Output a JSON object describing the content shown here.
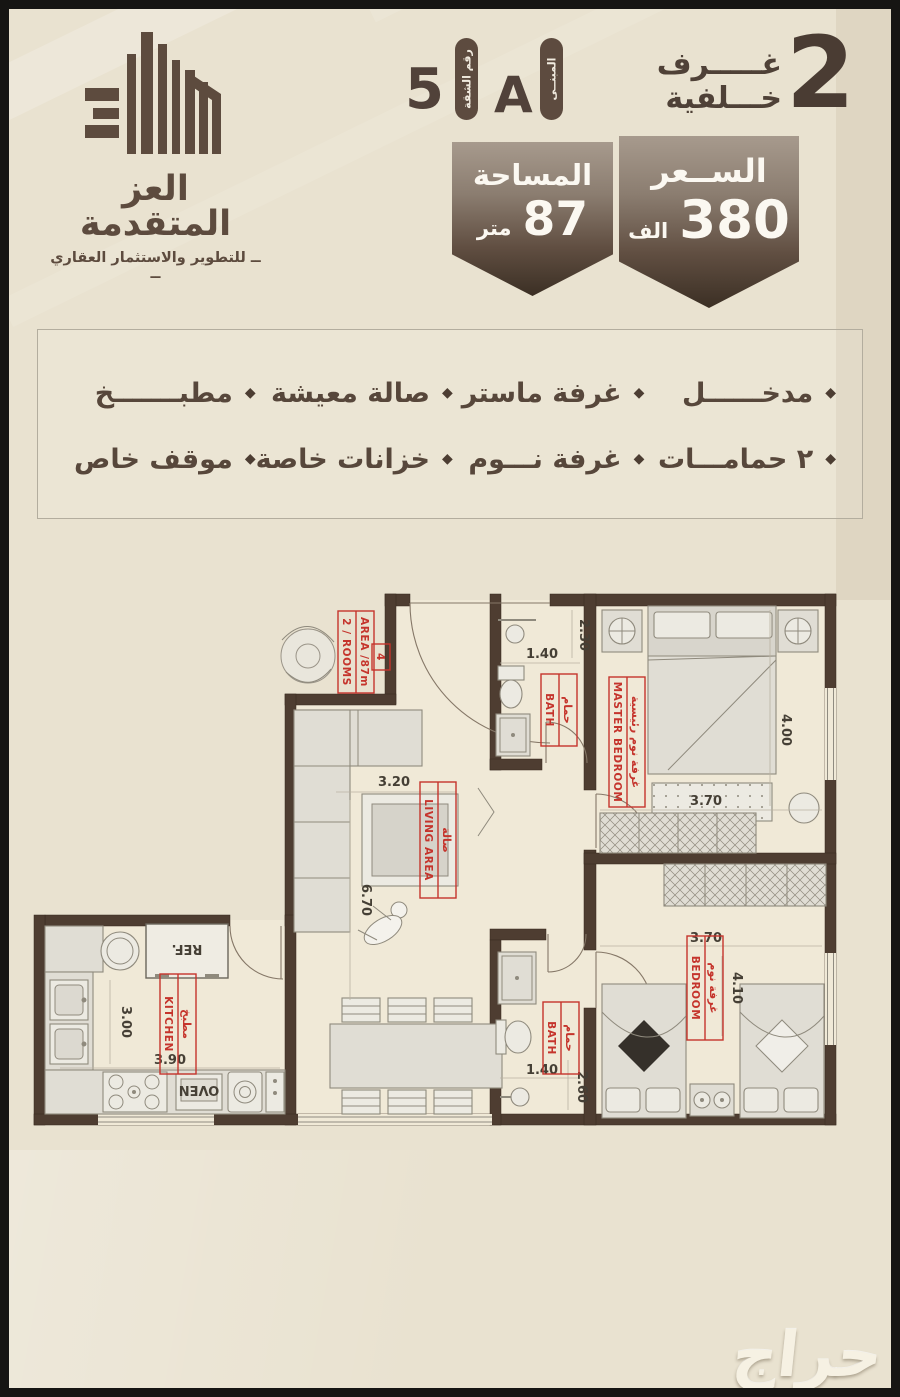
{
  "colors": {
    "brand_brown": "#5d4b3f",
    "header_text": "#4f4137",
    "badge_dark": "#3b2f24",
    "badge_light": "#a79a8d",
    "label_red": "#c5342c",
    "wall": "#4e3d31",
    "background": "#e9e2d0",
    "frame": "#161513"
  },
  "header": {
    "logo": {
      "title": "العز المتقدمة",
      "subtitle": "ــ للتطوير والاستثمار العقاري ــ"
    },
    "unit": {
      "number": "5",
      "number_label": "رقم الشقة",
      "building": "A",
      "building_label": "المبنــى"
    },
    "rooms": {
      "count": "2",
      "word": "غـــــرف",
      "type": "خـــلفية"
    }
  },
  "badges": {
    "area": {
      "title": "المساحة",
      "value": "87",
      "unit": "متر"
    },
    "price": {
      "title": "الســعر",
      "value": "380",
      "unit": "الف"
    }
  },
  "features": {
    "rows": [
      [
        "مدخــــــل",
        "غرفة ماستر",
        "صالة معيشة",
        "مطبـــــــخ"
      ],
      [
        "٢ حمامـــات",
        "غرفة نـــوم",
        "خزانات خاصة",
        "موقف خاص"
      ]
    ]
  },
  "floorplan": {
    "unit_tag": {
      "area": "AREA /87m",
      "rooms": "2 / ROOMS",
      "number": "4"
    },
    "labels": {
      "bath_top": {
        "ar": "حمام",
        "en": "BATH"
      },
      "master": {
        "ar": "غرفة نوم رئيسية",
        "en": "MASTER BEDROOM"
      },
      "living": {
        "ar": "صالة",
        "en": "LIVING AREA"
      },
      "kitchen": {
        "ar": "مطبخ",
        "en": "KITCHEN"
      },
      "bath_bottom": {
        "ar": "حمام",
        "en": "BATH"
      },
      "bedroom": {
        "ar": "غرفة نوم",
        "en": "BEDROOM"
      },
      "fridge": "REF.",
      "oven": "OVEN"
    },
    "dimensions": {
      "bath_top_w": "1.40",
      "bath_top_h": "2.30",
      "master_w": "3.70",
      "master_h": "4.00",
      "living_w": "3.20",
      "living_h": "6.70",
      "kitchen_w": "3.90",
      "kitchen_h": "3.00",
      "bath_bottom_w": "1.40",
      "bath_bottom_h": "2.60",
      "bedroom_w": "3.70",
      "bedroom_h": "4.10"
    }
  },
  "watermark": "حراج"
}
